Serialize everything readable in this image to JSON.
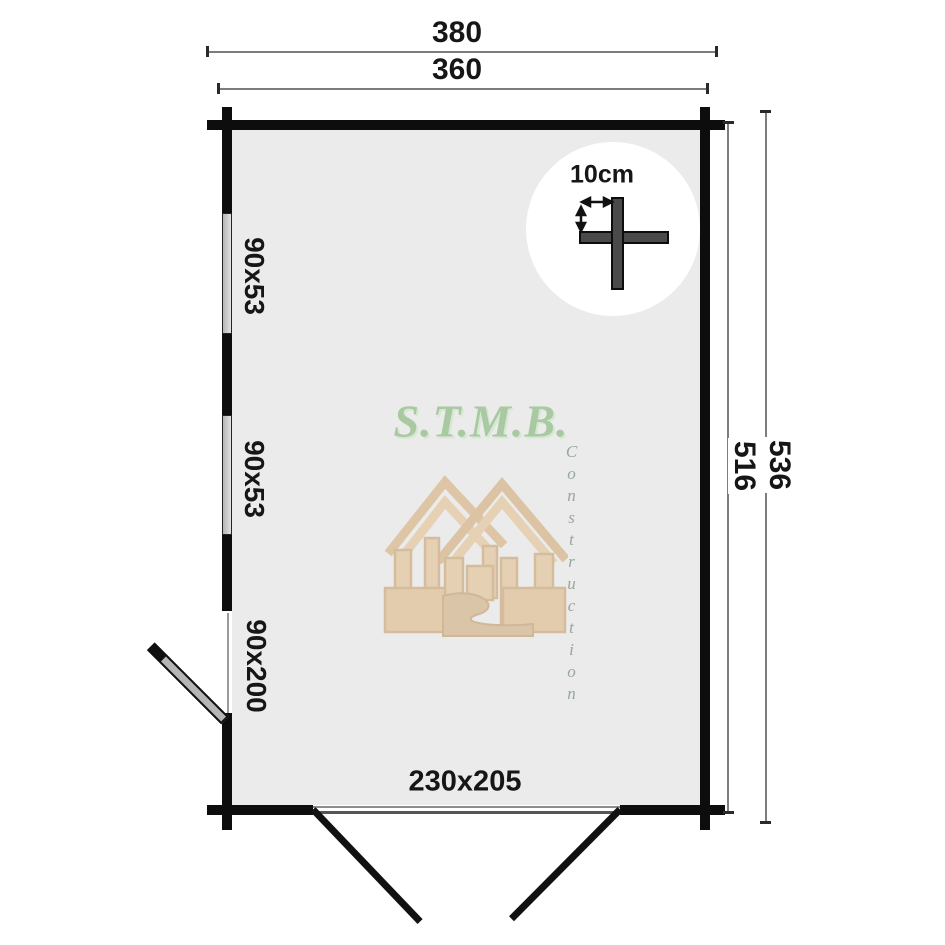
{
  "plan": {
    "dimensions": {
      "overall_width": "380",
      "wall_width": "360",
      "wall_depth": "516",
      "overall_depth": "536"
    },
    "openings": {
      "windows": [
        {
          "label": "90x53"
        },
        {
          "label": "90x53"
        }
      ],
      "side_door": {
        "label": "90x200"
      },
      "double_door": {
        "label": "230x205"
      }
    },
    "scale_indicator": {
      "label": "10cm"
    },
    "watermark": {
      "brand": "S.T.M.B.",
      "subtitle": "Construction"
    },
    "colors": {
      "wall": "#0d0d0d",
      "interior": "#ebebeb",
      "dimension_line": "#7d7d7d",
      "brand_green": "#a9c9a3",
      "watermark_tan": "#dcae72"
    }
  }
}
